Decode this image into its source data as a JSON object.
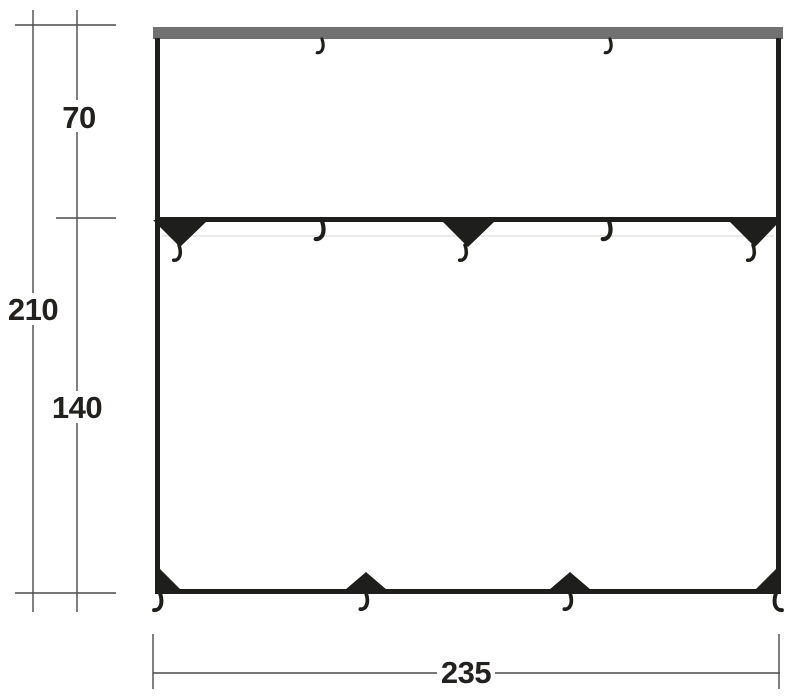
{
  "diagram": {
    "dimensions": {
      "total_height": {
        "label": "210"
      },
      "upper_section": {
        "label": "70"
      },
      "lower_section": {
        "label": "140"
      },
      "width": {
        "label": "235"
      }
    },
    "colors": {
      "panel_outline": "#1e1e1c",
      "pole_sleeve_bar": "#717171",
      "dimension_lines": "#4a4a4a",
      "label_text": "#232020",
      "background": "#ffffff"
    },
    "icons": {
      "hook": "guy-hook-icon",
      "patch": "reinforcement-patch-triangle"
    }
  }
}
